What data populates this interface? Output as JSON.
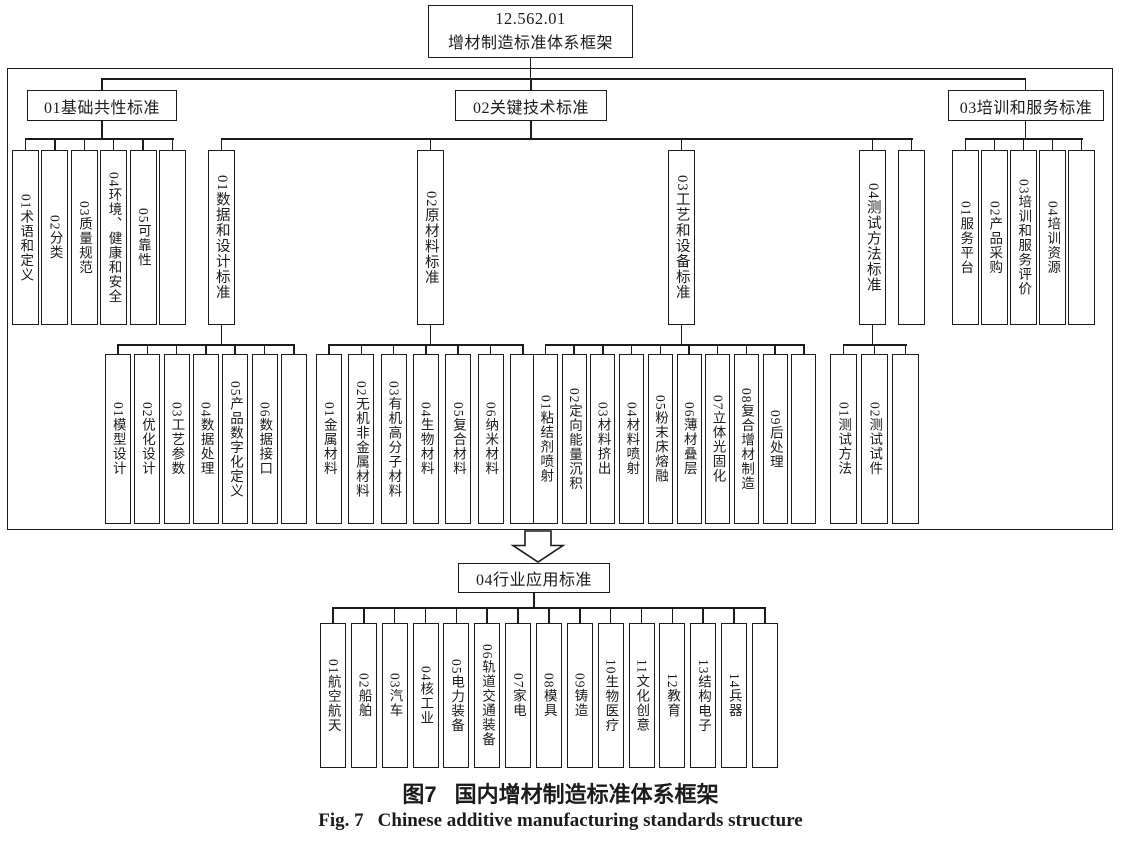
{
  "root": {
    "code": "12.562.01",
    "title": "增材制造标准体系框架"
  },
  "branches": {
    "basic": {
      "label": "01基础共性标准",
      "children": [
        "01术语和定义",
        "02分类",
        "03质量规范",
        "04环境、健康和安全",
        "05可靠性",
        ""
      ]
    },
    "key_tech": {
      "label": "02关键技术标准",
      "sub": [
        {
          "label": "01数据和设计标准",
          "children": [
            "01模型设计",
            "02优化设计",
            "03工艺参数",
            "04数据处理",
            "05产品数字化定义",
            "06数据接口",
            ""
          ]
        },
        {
          "label": "02原材料标准",
          "children": [
            "01金属材料",
            "02无机非金属材料",
            "03有机高分子材料",
            "04生物材料",
            "05复合材料",
            "06纳米材料",
            ""
          ]
        },
        {
          "label": "03工艺和设备标准",
          "children": [
            "01粘结剂喷射",
            "02定向能量沉积",
            "03材料挤出",
            "04材料喷射",
            "05粉末床熔融",
            "06薄材叠层",
            "07立体光固化",
            "08复合增材制造",
            "09后处理",
            ""
          ]
        },
        {
          "label": "04测试方法标准",
          "children": [
            "01测试方法",
            "02测试试件",
            ""
          ]
        },
        {
          "label": "",
          "children": []
        }
      ]
    },
    "training": {
      "label": "03培训和服务标准",
      "children": [
        "01服务平台",
        "02产品采购",
        "03培训和服务评价",
        "04培训资源",
        ""
      ]
    }
  },
  "industry": {
    "label": "04行业应用标准",
    "children": [
      "01航空航天",
      "02船舶",
      "03汽车",
      "04核工业",
      "05电力装备",
      "06轨道交通装备",
      "07家电",
      "08模具",
      "09铸造",
      "10生物医疗",
      "11文化创意",
      "12教育",
      "13结构电子",
      "14兵器",
      ""
    ]
  },
  "caption": {
    "zh_label": "图7",
    "zh_text": "国内增材制造标准体系框架",
    "en_label": "Fig. 7",
    "en_text": "Chinese additive manufacturing standards structure"
  },
  "colors": {
    "line": "#1b1b1b",
    "background": "#ffffff"
  }
}
